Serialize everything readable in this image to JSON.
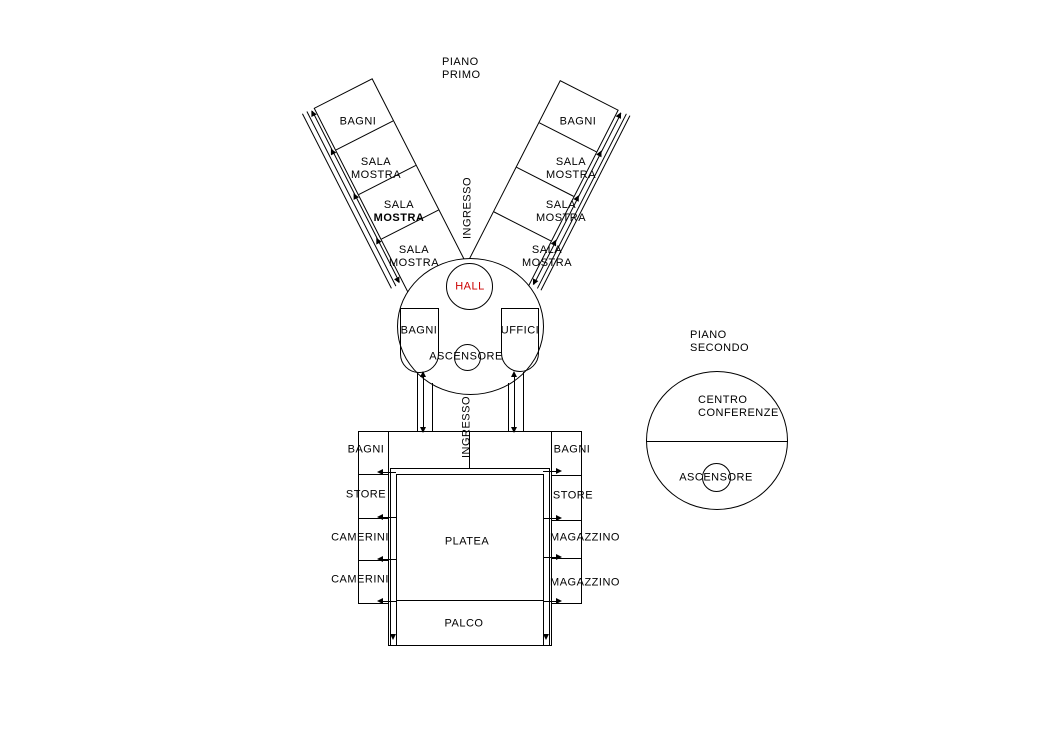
{
  "background": "#ffffff",
  "line_color": "#000000",
  "hall_color": "#cc0000",
  "floor1": {
    "title_line1": "PIANO",
    "title_line2": "PRIMO",
    "entrance_upper": "INGRESSO",
    "entrance_lower": "INGRESSO",
    "left_wing_rooms": [
      {
        "label": "BAGNI"
      },
      {
        "line1": "SALA",
        "line2": "MOSTRA"
      },
      {
        "line1": "SALA",
        "line2": "MOSTRA"
      },
      {
        "line1": "SALA",
        "line2": "MOSTRA"
      }
    ],
    "right_wing_rooms": [
      {
        "label": "BAGNI"
      },
      {
        "line1": "SALA",
        "line2": "MOSTRA"
      },
      {
        "line1": "SALA",
        "line2": "MOSTRA"
      },
      {
        "line1": "SALA",
        "line2": "MOSTRA"
      }
    ],
    "hall_label": "HALL",
    "circle_left_room": "BAGNI",
    "circle_right_room": "UFFICI",
    "elevator_label": "ASCENSORE",
    "theater_left_rooms": [
      "BAGNI",
      "STORE",
      "CAMERINI",
      "CAMERINI"
    ],
    "theater_right_rooms": [
      "BAGNI",
      "STORE",
      "MAGAZZINO",
      "MAGAZZINO"
    ],
    "stalls_label": "PLATEA",
    "stage_label": "PALCO"
  },
  "floor2": {
    "title_line1": "PIANO",
    "title_line2": "SECONDO",
    "conference_line1": "CENTRO",
    "conference_line2": "CONFERENZE",
    "elevator_label": "ASCENSORE"
  }
}
